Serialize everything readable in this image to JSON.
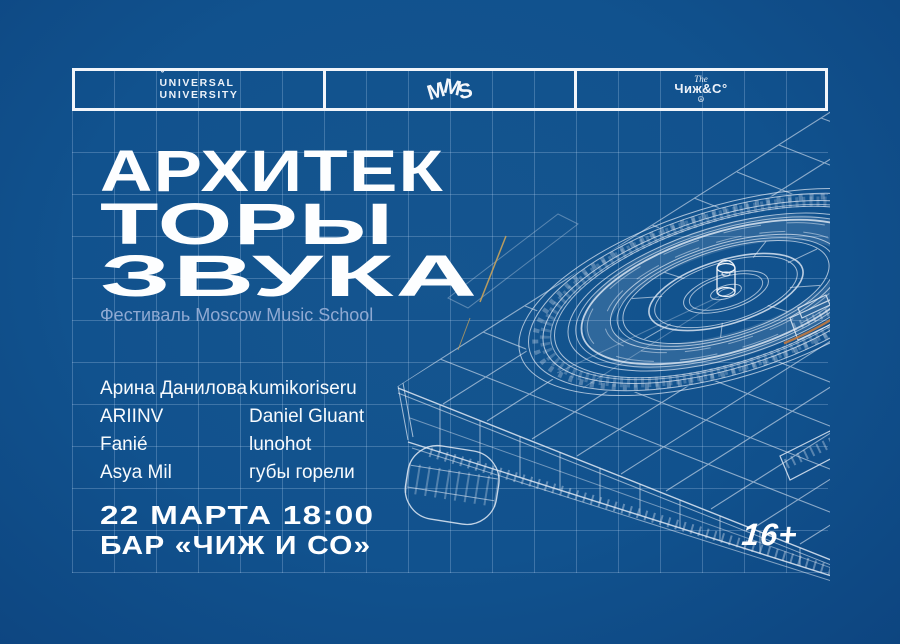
{
  "poster": {
    "header": {
      "universal": {
        "accent": "ˇ",
        "line1": "UNIVERSAL",
        "line2": "UNIVERSITY"
      },
      "mms": {
        "letters": [
          "M",
          "M",
          "S"
        ]
      },
      "chizh": {
        "the": "The",
        "name": "Чиж&С°",
        "bird_glyph": "☮"
      }
    },
    "title": {
      "line1": "АРХИТЕК",
      "line2": "ТОРЫ",
      "line3": "ЗВУКА"
    },
    "subtitle": "Фестиваль Moscow Music School",
    "lineup": {
      "column1": [
        "Арина Данилова",
        "ARIINV",
        "Fanié",
        "Asya Mil"
      ],
      "column2": [
        "kumikoriseru",
        "Daniel Gluant",
        "lunohot",
        "губы горели"
      ]
    },
    "event": {
      "datetime": "22 МАРТА 18:00",
      "venue": "БАР «ЧИЖ И СО»"
    },
    "age_rating": "16+",
    "colors": {
      "background": "#11528E",
      "background_edge": "#0D4580",
      "grid_line": "#BED6F3",
      "wireframe": "#DFE8F4",
      "subtitle_text": "#8FA9D2",
      "accent_gold": "#C9A35B",
      "accent_orange": "#C07A43",
      "text": "#FFFFFF"
    }
  }
}
